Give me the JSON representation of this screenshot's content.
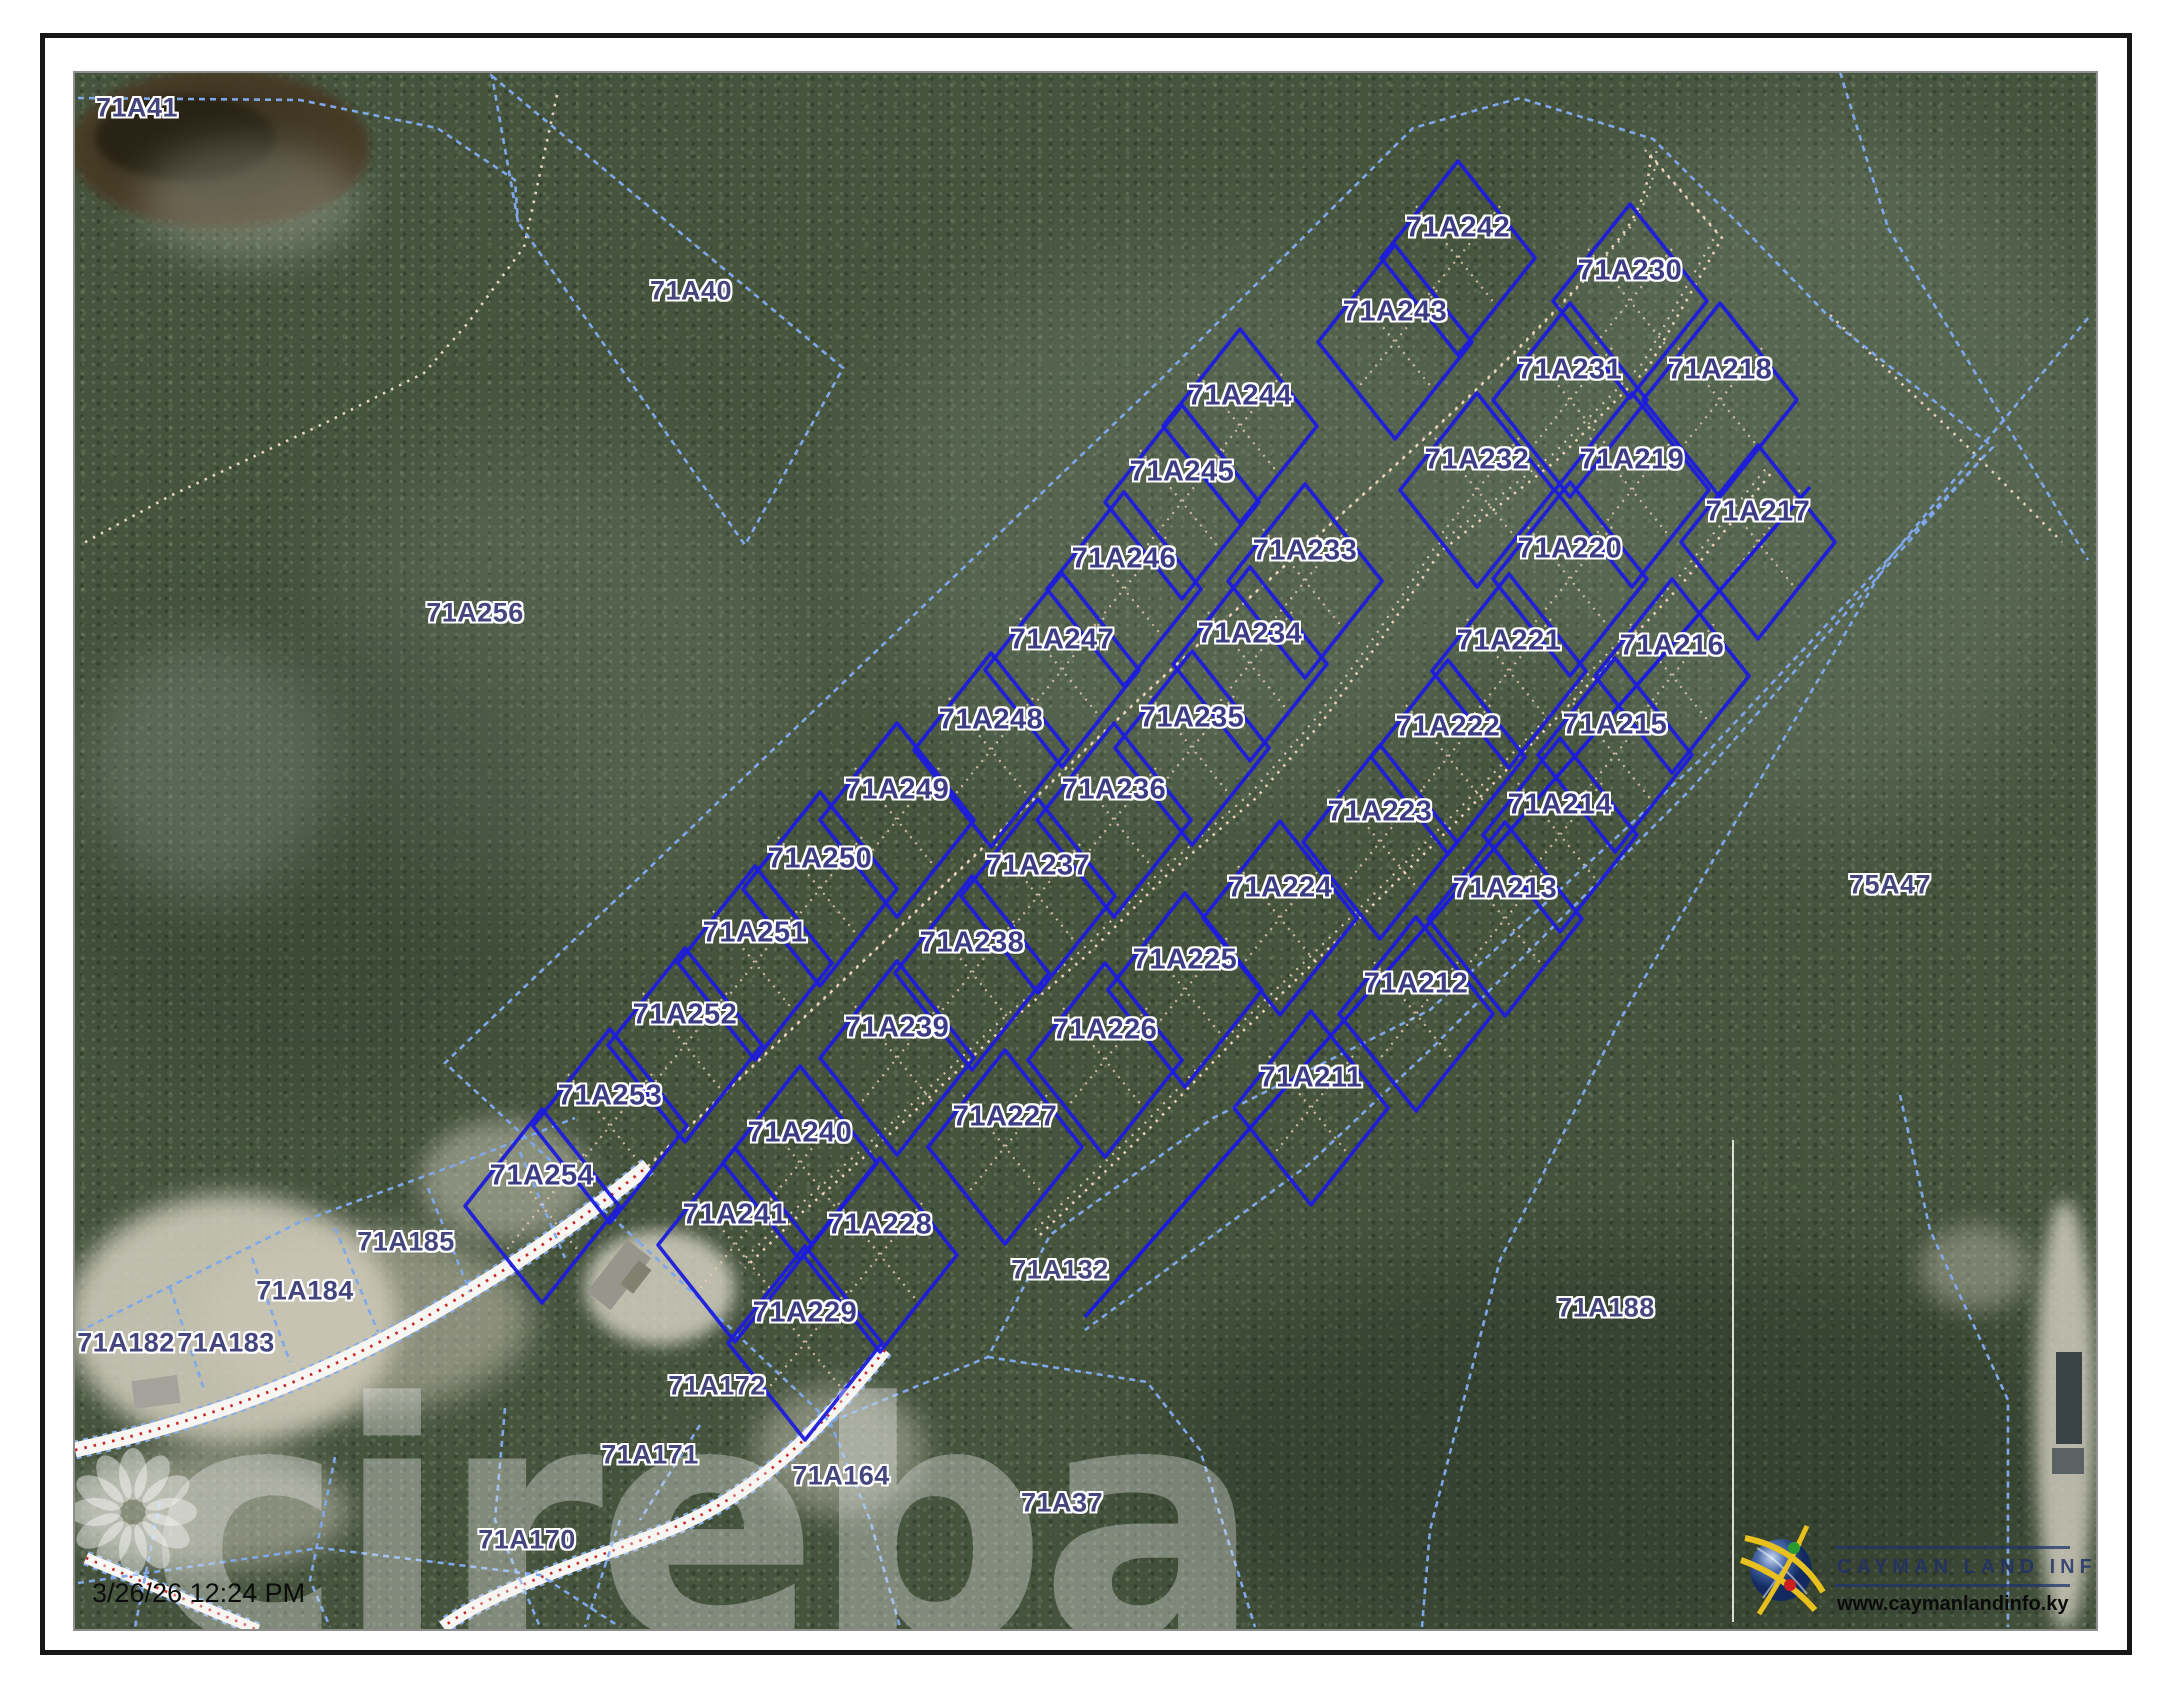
{
  "timestamp": "3/26/26 12:24 PM",
  "watermark": {
    "brand": "cireba",
    "icon": "flower-petals-icon"
  },
  "branding": {
    "title": "CAYMAN LAND INFO",
    "website": "www.caymanlandinfo.ky",
    "icon": "globe-arcs-icon"
  },
  "colors": {
    "subdivision_line": "#1b1bdd",
    "dashed_boundary": "#7fa8ea",
    "label_text": "#3c3c85",
    "trail_dots": "#efcfb8",
    "road_centerline": "#c62828",
    "forest_base": "#46543e",
    "sand": "#d5d0c0"
  },
  "parcels": {
    "subdivision_lots": [
      {
        "id": "71A242",
        "x": 1458,
        "y": 228
      },
      {
        "id": "71A243",
        "x": 1395,
        "y": 312
      },
      {
        "id": "71A244",
        "x": 1240,
        "y": 396
      },
      {
        "id": "71A245",
        "x": 1182,
        "y": 472
      },
      {
        "id": "71A246",
        "x": 1124,
        "y": 559
      },
      {
        "id": "71A247",
        "x": 1062,
        "y": 640
      },
      {
        "id": "71A248",
        "x": 991,
        "y": 720
      },
      {
        "id": "71A249",
        "x": 897,
        "y": 790
      },
      {
        "id": "71A250",
        "x": 820,
        "y": 859
      },
      {
        "id": "71A251",
        "x": 755,
        "y": 933
      },
      {
        "id": "71A252",
        "x": 685,
        "y": 1015
      },
      {
        "id": "71A253",
        "x": 610,
        "y": 1096
      },
      {
        "id": "71A254",
        "x": 542,
        "y": 1176
      },
      {
        "id": "71A230",
        "x": 1630,
        "y": 271
      },
      {
        "id": "71A231",
        "x": 1570,
        "y": 370
      },
      {
        "id": "71A232",
        "x": 1477,
        "y": 460
      },
      {
        "id": "71A233",
        "x": 1305,
        "y": 551
      },
      {
        "id": "71A234",
        "x": 1250,
        "y": 634
      },
      {
        "id": "71A235",
        "x": 1192,
        "y": 718
      },
      {
        "id": "71A236",
        "x": 1114,
        "y": 790
      },
      {
        "id": "71A237",
        "x": 1038,
        "y": 866
      },
      {
        "id": "71A238",
        "x": 972,
        "y": 943
      },
      {
        "id": "71A239",
        "x": 897,
        "y": 1028
      },
      {
        "id": "71A240",
        "x": 800,
        "y": 1133
      },
      {
        "id": "71A241",
        "x": 735,
        "y": 1215
      },
      {
        "id": "71A218",
        "x": 1720,
        "y": 370
      },
      {
        "id": "71A219",
        "x": 1632,
        "y": 460
      },
      {
        "id": "71A220",
        "x": 1570,
        "y": 549
      },
      {
        "id": "71A221",
        "x": 1509,
        "y": 641
      },
      {
        "id": "71A222",
        "x": 1448,
        "y": 727
      },
      {
        "id": "71A223",
        "x": 1380,
        "y": 812
      },
      {
        "id": "71A224",
        "x": 1280,
        "y": 888
      },
      {
        "id": "71A225",
        "x": 1185,
        "y": 960
      },
      {
        "id": "71A226",
        "x": 1105,
        "y": 1030
      },
      {
        "id": "71A227",
        "x": 1005,
        "y": 1117
      },
      {
        "id": "71A228",
        "x": 880,
        "y": 1225
      },
      {
        "id": "71A229",
        "x": 805,
        "y": 1313
      },
      {
        "id": "71A217",
        "x": 1758,
        "y": 512
      },
      {
        "id": "71A216",
        "x": 1672,
        "y": 646
      },
      {
        "id": "71A215",
        "x": 1615,
        "y": 725
      },
      {
        "id": "71A214",
        "x": 1560,
        "y": 805
      },
      {
        "id": "71A213",
        "x": 1505,
        "y": 889
      },
      {
        "id": "71A212",
        "x": 1416,
        "y": 984
      },
      {
        "id": "71A211",
        "x": 1311,
        "y": 1078
      }
    ],
    "surrounding_lots": [
      {
        "id": "71A41",
        "x": 137,
        "y": 108
      },
      {
        "id": "71A40",
        "x": 691,
        "y": 291
      },
      {
        "id": "71A256",
        "x": 475,
        "y": 613
      },
      {
        "id": "75A47",
        "x": 1890,
        "y": 885
      },
      {
        "id": "71A188",
        "x": 1606,
        "y": 1308
      },
      {
        "id": "71A37",
        "x": 1062,
        "y": 1503
      },
      {
        "id": "71A132",
        "x": 1060,
        "y": 1270
      },
      {
        "id": "71A185",
        "x": 406,
        "y": 1242
      },
      {
        "id": "71A184",
        "x": 305,
        "y": 1291
      },
      {
        "id": "71A183",
        "x": 226,
        "y": 1343
      },
      {
        "id": "71A182",
        "x": 126,
        "y": 1343
      },
      {
        "id": "71A172",
        "x": 717,
        "y": 1386
      },
      {
        "id": "71A171",
        "x": 650,
        "y": 1455
      },
      {
        "id": "71A170",
        "x": 527,
        "y": 1540
      },
      {
        "id": "71A164",
        "x": 841,
        "y": 1476
      }
    ]
  }
}
